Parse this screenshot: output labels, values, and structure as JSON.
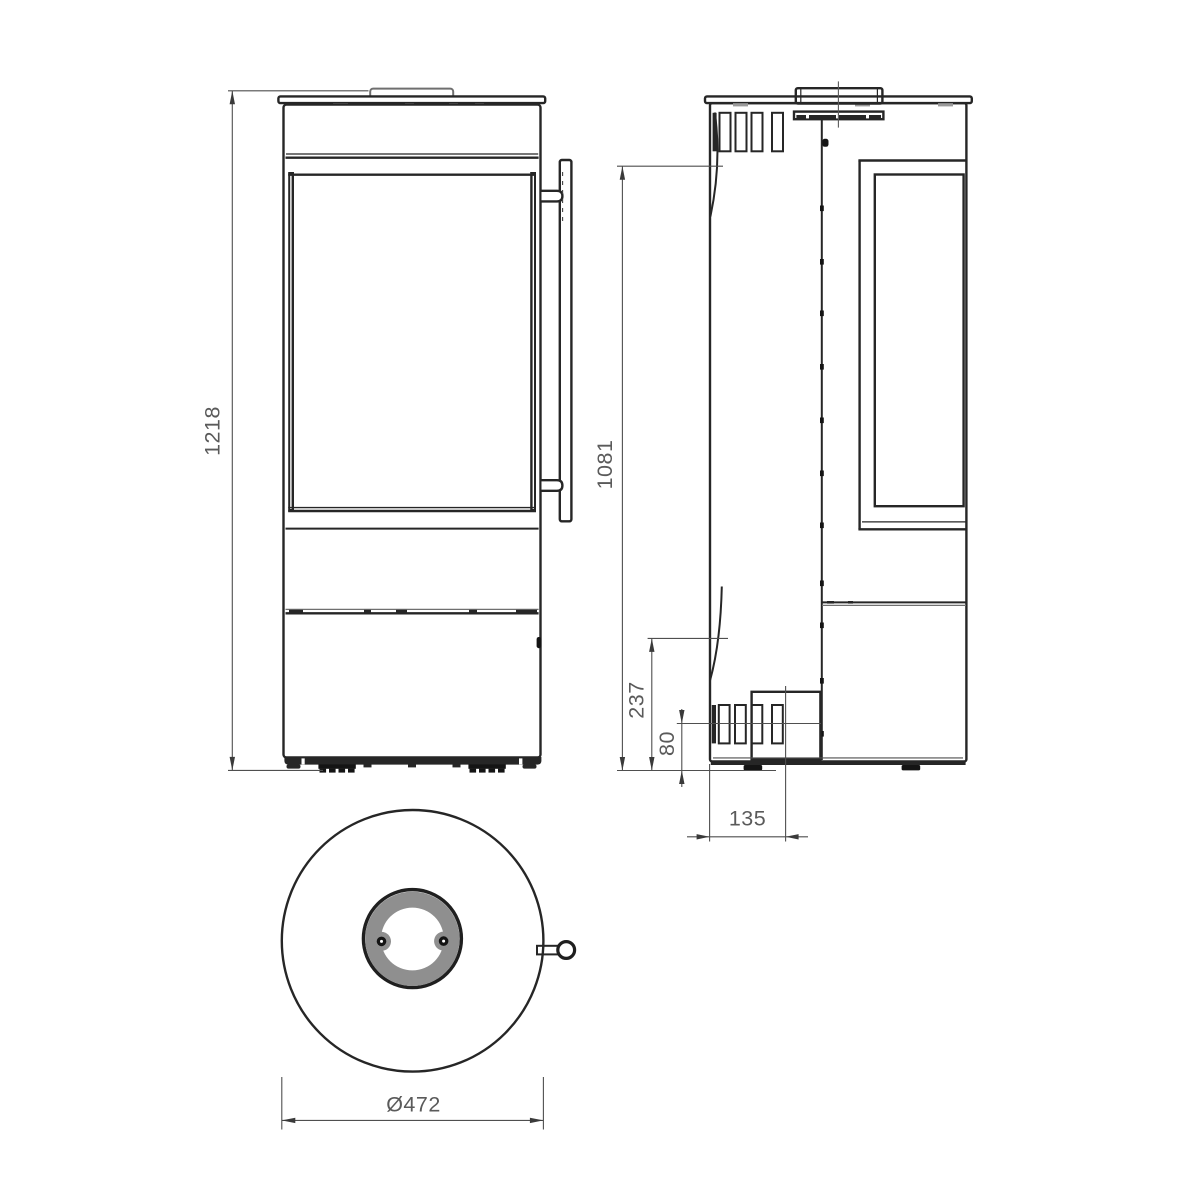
{
  "drawing": {
    "views": {
      "front": {
        "dim_height": {
          "value": "1218"
        }
      },
      "side": {
        "dim_body_height": {
          "value": "1081"
        },
        "dim_lower_zone": {
          "value": "237"
        },
        "dim_intake_center_height": {
          "value": "80"
        },
        "dim_intake_offset": {
          "value": "135"
        }
      },
      "top": {
        "dim_diameter": {
          "value": "Ø472"
        }
      }
    },
    "colors": {
      "background": "#ffffff",
      "outline": "#262626",
      "dim_line": "#4f4f4f",
      "dim_text": "#5a5a5a",
      "flue_ring_fill": "#8f8f8f",
      "dark_fill": "#141414"
    }
  }
}
